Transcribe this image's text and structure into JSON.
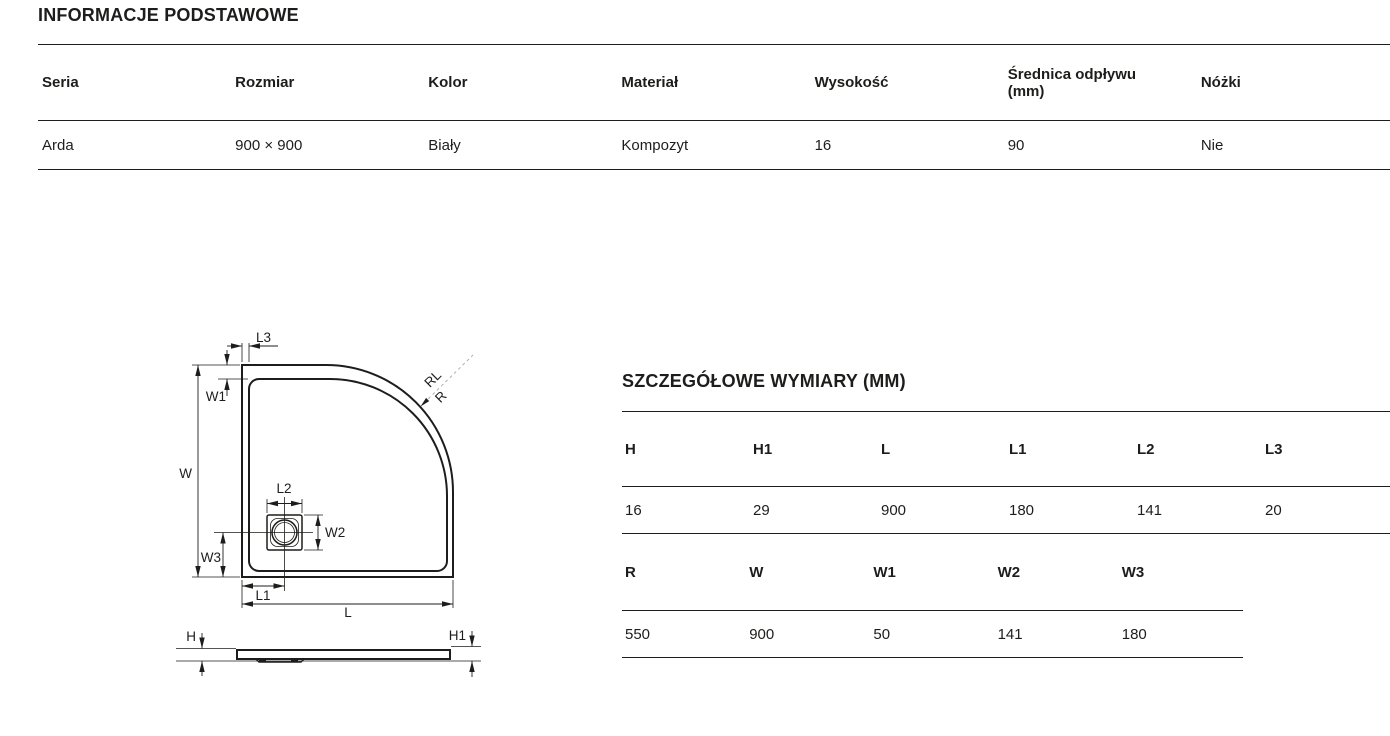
{
  "colors": {
    "text": "#1d1d1b",
    "table_line": "#1d1d1b",
    "diagram_dash": "#a9a9a9",
    "background": "#ffffff"
  },
  "basic_info": {
    "title": "INFORMACJE PODSTAWOWE",
    "columns": [
      "Seria",
      "Rozmiar",
      "Kolor",
      "Materiał",
      "Wysokość",
      "Średnica odpływu\n(mm)",
      "Nóżki"
    ],
    "row": [
      "Arda",
      "900 × 900",
      "Biały",
      "Kompozyt",
      "16",
      "90",
      "Nie"
    ]
  },
  "detailed_dimensions": {
    "title": "SZCZEGÓŁOWE WYMIARY (MM)",
    "length_table": {
      "columns": [
        "H",
        "H1",
        "L",
        "L1",
        "L2",
        "L3"
      ],
      "row": [
        "16",
        "29",
        "900",
        "180",
        "141",
        "20"
      ]
    },
    "width_table": {
      "columns": [
        "R",
        "W",
        "W1",
        "W2",
        "W3"
      ],
      "row": [
        "550",
        "900",
        "50",
        "141",
        "180"
      ]
    }
  },
  "diagram": {
    "top_view_labels": {
      "L3": "L3",
      "W1": "W1",
      "W": "W",
      "L2": "L2",
      "W2": "W2",
      "W3": "W3",
      "L1": "L1",
      "L": "L",
      "RL": "RL",
      "R": "R"
    },
    "side_view_labels": {
      "H": "H",
      "H1": "H1"
    }
  }
}
